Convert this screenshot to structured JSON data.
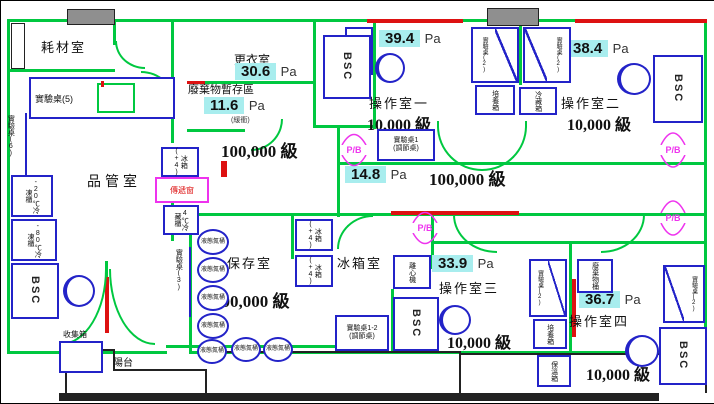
{
  "colors": {
    "wall_green": "#00c840",
    "equipment_blue": "#2323c8",
    "passbox_magenta": "#ee33ee",
    "highlight_cyan": "#a8edee",
    "alert_red": "#dd1111",
    "block_gray": "#8f8f8f"
  },
  "rooms": {
    "consumables": {
      "name": "耗材室"
    },
    "qc": {
      "name": "品管室"
    },
    "changing": {
      "name": "更衣室",
      "pressure": "30.6",
      "unit": "Pa"
    },
    "waste": {
      "name": "廢棄物暫存區",
      "pressure": "11.6",
      "unit": "Pa",
      "note": "(緩衝)"
    },
    "corridor_top": {
      "class": "100,000 級"
    },
    "corridor_mid": {
      "pressure": "14.8",
      "unit": "Pa",
      "class": "100,000 級"
    },
    "storage": {
      "name": "保存室",
      "class": "100,000 級"
    },
    "fridge": {
      "name": "冰箱室"
    },
    "op1": {
      "name": "操作室一",
      "class": "10,000 級",
      "pressure": "39.4",
      "unit": "Pa"
    },
    "op2": {
      "name": "操作室二",
      "class": "10,000 級",
      "pressure": "38.4",
      "unit": "Pa"
    },
    "op3": {
      "name": "操作室三",
      "class": "10,000 級",
      "pressure": "33.9",
      "unit": "Pa"
    },
    "op4": {
      "name": "操作室四",
      "class": "10,000 級",
      "pressure": "36.7",
      "unit": "Pa"
    },
    "balcony": {
      "name": "陽台"
    }
  },
  "equipment": {
    "bsc": "BSC",
    "passbox": "P/B",
    "pass_window": "傳遞窗",
    "bench5": "實驗桌(5)",
    "bench6": "實驗桌(6)",
    "bench3": "實驗桌(3)",
    "bench2": "實驗桌(2)",
    "bench1": "實驗桌1",
    "bench1_note": "(調節桌)",
    "bench12": "實驗桌1-2",
    "bench12_note": "(調節桌)",
    "freezer_minus20": "-20℃冷凍櫃",
    "freezer_minus80": "-80℃冷凍櫃",
    "fridge_4c": "4℃冷藏櫃",
    "fridge_plus4": "冰箱(+4)",
    "coat_cabinet": "外衣櫃",
    "incubator": "培養箱",
    "cold_box": "冷藏箱",
    "centrifuge": "離心機",
    "warm_box": "保溫箱",
    "waste_bin": "廢棄物桶",
    "ln2_tank": "液態氮桶",
    "collection_box": "收集箱"
  }
}
